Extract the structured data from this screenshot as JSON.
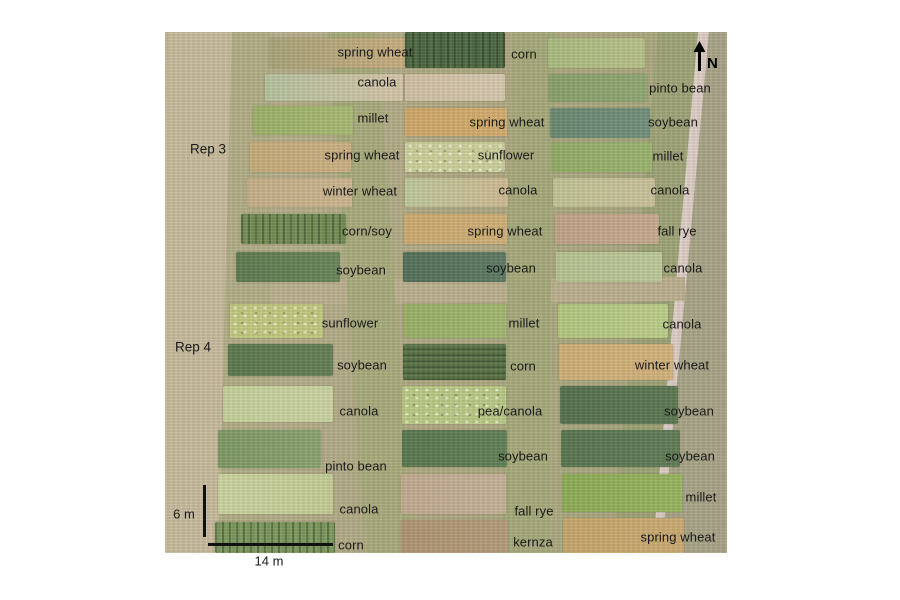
{
  "figure": {
    "type": "annotated-aerial-photo",
    "description": "UAV aerial photograph of agricultural research plots with crop labels",
    "north_label": "N",
    "rep_labels": [
      {
        "text": "Rep 3"
      },
      {
        "text": "Rep 4"
      }
    ],
    "scale_bars": {
      "vertical_label": "6 m",
      "horizontal_label": "14 m"
    },
    "background_elements": [
      {
        "name": "dirt-track-left",
        "x": -4,
        "y": -12,
        "w": 64,
        "h": 548,
        "rotate": 1.5,
        "fill": "#c8bb9e"
      },
      {
        "name": "grass-margin-left",
        "x": 58,
        "y": -12,
        "w": 48,
        "h": 548,
        "rotate": 0.5,
        "fill": "#b2ae88"
      },
      {
        "name": "aisle-left-mid",
        "x": 182,
        "y": -12,
        "w": 48,
        "h": 548,
        "rotate": -4,
        "fill": "#a9ac7d"
      },
      {
        "name": "aisle-mid-right",
        "x": 342,
        "y": -12,
        "w": 44,
        "h": 548,
        "rotate": 1,
        "fill": "#a6aa7b"
      },
      {
        "name": "rep-break-strip",
        "x": 45,
        "y": 247,
        "w": 475,
        "h": 24,
        "rotate": -0.5,
        "fill": "#bcb190"
      },
      {
        "name": "grass-verge-right",
        "x": 470,
        "y": -12,
        "w": 40,
        "h": 548,
        "rotate": 5,
        "fill": "#9fa478"
      },
      {
        "name": "road",
        "x": 484,
        "y": -14,
        "w": 36,
        "h": 552,
        "rotate": 5.2,
        "fill": "#e9dfdc",
        "fill2": "#dcccc4"
      },
      {
        "name": "far-grass-right",
        "x": 516,
        "y": -14,
        "w": 72,
        "h": 552,
        "rotate": 5.2,
        "fill": "#a8a488"
      }
    ],
    "plots": [
      {
        "crop": "spring wheat",
        "col": "left",
        "row": 1,
        "rect": {
          "x": 105,
          "y": 6,
          "w": 137,
          "h": 30
        },
        "fill": "#aaa47a",
        "fill2": "#c9ae80",
        "texture": null,
        "label": {
          "x": 210,
          "y": 20
        }
      },
      {
        "crop": "canola",
        "col": "left",
        "row": 2,
        "rect": {
          "x": 100,
          "y": 42,
          "w": 138,
          "h": 27
        },
        "fill": "#b5c3a0",
        "fill2": "#d6c6aa",
        "texture": null,
        "label": {
          "x": 212,
          "y": 50
        }
      },
      {
        "crop": "millet",
        "col": "left",
        "row": 3,
        "rect": {
          "x": 88,
          "y": 74,
          "w": 100,
          "h": 29
        },
        "fill": "#9cb169",
        "fill2": "#a9ba75",
        "texture": null,
        "label": {
          "x": 208,
          "y": 86
        }
      },
      {
        "crop": "spring wheat",
        "col": "left",
        "row": 4,
        "rect": {
          "x": 85,
          "y": 110,
          "w": 101,
          "h": 30
        },
        "fill": "#c6ac7b",
        "fill2": "#ccb184",
        "texture": null,
        "label": {
          "x": 197,
          "y": 123
        }
      },
      {
        "crop": "winter wheat",
        "col": "left",
        "row": 5,
        "rect": {
          "x": 82,
          "y": 146,
          "w": 105,
          "h": 29
        },
        "fill": "#c6b089",
        "fill2": "#cdb591",
        "texture": null,
        "label": {
          "x": 195,
          "y": 159
        }
      },
      {
        "crop": "corn/soy",
        "col": "left",
        "row": 6,
        "rect": {
          "x": 76,
          "y": 182,
          "w": 105,
          "h": 30
        },
        "fill": "#748d56",
        "fill2": null,
        "texture": "rows-v",
        "label": {
          "x": 202,
          "y": 199
        }
      },
      {
        "crop": "soybean",
        "col": "left",
        "row": 7,
        "rect": {
          "x": 71,
          "y": 220,
          "w": 104,
          "h": 30
        },
        "fill": "#5e7a50",
        "fill2": "#68855a",
        "texture": null,
        "label": {
          "x": 196,
          "y": 238
        }
      },
      {
        "crop": "sunflower",
        "col": "left",
        "row": 8,
        "rect": {
          "x": 65,
          "y": 272,
          "w": 93,
          "h": 34
        },
        "fill": "#c1c980",
        "fill2": null,
        "texture": "speckle",
        "label": {
          "x": 185,
          "y": 291
        }
      },
      {
        "crop": "soybean",
        "col": "left",
        "row": 9,
        "rect": {
          "x": 63,
          "y": 312,
          "w": 105,
          "h": 32
        },
        "fill": "#5c784f",
        "fill2": "#647f56",
        "texture": null,
        "label": {
          "x": 197,
          "y": 333
        }
      },
      {
        "crop": "canola",
        "col": "left",
        "row": 10,
        "rect": {
          "x": 58,
          "y": 354,
          "w": 110,
          "h": 36
        },
        "fill": "#c6d19c",
        "fill2": "#ccd5a3",
        "texture": null,
        "label": {
          "x": 194,
          "y": 379
        }
      },
      {
        "crop": "pinto bean",
        "col": "left",
        "row": 11,
        "rect": {
          "x": 53,
          "y": 398,
          "w": 103,
          "h": 38
        },
        "fill": "#7e9965",
        "fill2": "#8aa471",
        "texture": null,
        "label": {
          "x": 191,
          "y": 434
        }
      },
      {
        "crop": "canola",
        "col": "left",
        "row": 12,
        "rect": {
          "x": 53,
          "y": 442,
          "w": 115,
          "h": 40
        },
        "fill": "#ccd4a1",
        "fill2": "#c4ce97",
        "texture": null,
        "label": {
          "x": 194,
          "y": 477
        }
      },
      {
        "crop": "corn",
        "col": "left",
        "row": 13,
        "rect": {
          "x": 50,
          "y": 490,
          "w": 120,
          "h": 31
        },
        "fill": "#7d995e",
        "fill2": null,
        "texture": "rows-v",
        "label": {
          "x": 186,
          "y": 513
        }
      },
      {
        "crop": "corn",
        "col": "middle",
        "row": 1,
        "rect": {
          "x": 240,
          "y": 0,
          "w": 100,
          "h": 36
        },
        "fill": "#4d6943",
        "fill2": null,
        "texture": "rows-v",
        "label": {
          "x": 359,
          "y": 22
        }
      },
      {
        "crop": null,
        "col": "middle",
        "row": 2,
        "rect": {
          "x": 240,
          "y": 42,
          "w": 100,
          "h": 27
        },
        "fill": "#d2c1a7",
        "fill2": "#d8c9b0",
        "texture": null,
        "label": null
      },
      {
        "crop": "spring wheat",
        "col": "middle",
        "row": 3,
        "rect": {
          "x": 240,
          "y": 76,
          "w": 102,
          "h": 28
        },
        "fill": "#d0a769",
        "fill2": "#d4ad6f",
        "texture": null,
        "label": {
          "x": 342,
          "y": 90
        }
      },
      {
        "crop": "sunflower",
        "col": "middle",
        "row": 4,
        "rect": {
          "x": 240,
          "y": 110,
          "w": 100,
          "h": 30
        },
        "fill": "#ccd19c",
        "fill2": null,
        "texture": "speckle",
        "label": {
          "x": 341,
          "y": 123
        }
      },
      {
        "crop": "canola",
        "col": "middle",
        "row": 5,
        "rect": {
          "x": 240,
          "y": 146,
          "w": 103,
          "h": 29
        },
        "fill": "#bfc99d",
        "fill2": "#cfbc94",
        "texture": null,
        "label": {
          "x": 353,
          "y": 158
        }
      },
      {
        "crop": "spring wheat",
        "col": "middle",
        "row": 6,
        "rect": {
          "x": 239,
          "y": 182,
          "w": 103,
          "h": 30
        },
        "fill": "#cdab71",
        "fill2": "#d1b078",
        "texture": null,
        "label": {
          "x": 340,
          "y": 199
        }
      },
      {
        "crop": "soybean",
        "col": "middle",
        "row": 7,
        "rect": {
          "x": 238,
          "y": 220,
          "w": 103,
          "h": 30
        },
        "fill": "#546f5b",
        "fill2": "#5d7a64",
        "texture": null,
        "label": {
          "x": 346,
          "y": 236
        }
      },
      {
        "crop": "millet",
        "col": "middle",
        "row": 8,
        "rect": {
          "x": 238,
          "y": 272,
          "w": 103,
          "h": 34
        },
        "fill": "#99b066",
        "fill2": "#a3b871",
        "texture": null,
        "label": {
          "x": 359,
          "y": 291
        }
      },
      {
        "crop": "corn",
        "col": "middle",
        "row": 9,
        "rect": {
          "x": 238,
          "y": 312,
          "w": 103,
          "h": 36
        },
        "fill": "#5b7449",
        "fill2": null,
        "texture": "rows-h",
        "label": {
          "x": 358,
          "y": 334
        }
      },
      {
        "crop": "pea/canola",
        "col": "middle",
        "row": 10,
        "rect": {
          "x": 237,
          "y": 354,
          "w": 104,
          "h": 38
        },
        "fill": "#bac986",
        "fill2": null,
        "texture": "speckle",
        "label": {
          "x": 345,
          "y": 379
        }
      },
      {
        "crop": "soybean",
        "col": "middle",
        "row": 11,
        "rect": {
          "x": 237,
          "y": 398,
          "w": 105,
          "h": 37
        },
        "fill": "#597850",
        "fill2": "#617f57",
        "texture": null,
        "label": {
          "x": 358,
          "y": 424
        }
      },
      {
        "crop": "fall rye",
        "col": "middle",
        "row": 12,
        "rect": {
          "x": 236,
          "y": 442,
          "w": 105,
          "h": 40
        },
        "fill": "#c1ac91",
        "fill2": "#c7b29a",
        "texture": null,
        "label": {
          "x": 369,
          "y": 479
        }
      },
      {
        "crop": "kernza",
        "col": "middle",
        "row": 13,
        "rect": {
          "x": 236,
          "y": 488,
          "w": 107,
          "h": 33
        },
        "fill": "#af9573",
        "fill2": "#b59c7c",
        "texture": null,
        "label": {
          "x": 368,
          "y": 510
        }
      },
      {
        "crop": null,
        "col": "right",
        "row": 1,
        "rect": {
          "x": 383,
          "y": 6,
          "w": 97,
          "h": 30
        },
        "fill": "#abbc81",
        "fill2": "#b8c28b",
        "texture": null,
        "label": null
      },
      {
        "crop": "pinto bean",
        "col": "right",
        "row": 2,
        "rect": {
          "x": 384,
          "y": 42,
          "w": 98,
          "h": 28
        },
        "fill": "#89a06b",
        "fill2": "#91a873",
        "texture": null,
        "label": {
          "x": 515,
          "y": 56
        }
      },
      {
        "crop": "soybean",
        "col": "right",
        "row": 3,
        "rect": {
          "x": 385,
          "y": 76,
          "w": 100,
          "h": 30
        },
        "fill": "#6a8973",
        "fill2": "#728f7b",
        "texture": null,
        "label": {
          "x": 508,
          "y": 90
        }
      },
      {
        "crop": "millet",
        "col": "right",
        "row": 4,
        "rect": {
          "x": 387,
          "y": 110,
          "w": 100,
          "h": 30
        },
        "fill": "#93ac67",
        "fill2": "#9cb470",
        "texture": null,
        "label": {
          "x": 503,
          "y": 124
        }
      },
      {
        "crop": "canola",
        "col": "right",
        "row": 5,
        "rect": {
          "x": 388,
          "y": 146,
          "w": 102,
          "h": 29
        },
        "fill": "#c1c596",
        "fill2": "#ccc29b",
        "texture": null,
        "label": {
          "x": 505,
          "y": 158
        }
      },
      {
        "crop": "fall rye",
        "col": "right",
        "row": 6,
        "rect": {
          "x": 390,
          "y": 182,
          "w": 104,
          "h": 30
        },
        "fill": "#c2a389",
        "fill2": "#c8ab90",
        "texture": null,
        "label": {
          "x": 512,
          "y": 199
        }
      },
      {
        "crop": "canola",
        "col": "right",
        "row": 7,
        "rect": {
          "x": 391,
          "y": 220,
          "w": 106,
          "h": 30
        },
        "fill": "#b6c493",
        "fill2": "#bdca9a",
        "texture": null,
        "label": {
          "x": 518,
          "y": 236
        }
      },
      {
        "crop": "canola",
        "col": "right",
        "row": 8,
        "rect": {
          "x": 393,
          "y": 272,
          "w": 110,
          "h": 34
        },
        "fill": "#b3c881",
        "fill2": "#bcce8a",
        "texture": null,
        "label": {
          "x": 517,
          "y": 292
        }
      },
      {
        "crop": "winter wheat",
        "col": "right",
        "row": 9,
        "rect": {
          "x": 394,
          "y": 312,
          "w": 114,
          "h": 36
        },
        "fill": "#cfaf76",
        "fill2": "#d3b37c",
        "texture": null,
        "label": {
          "x": 507,
          "y": 333
        }
      },
      {
        "crop": "soybean",
        "col": "right",
        "row": 10,
        "rect": {
          "x": 395,
          "y": 354,
          "w": 118,
          "h": 38
        },
        "fill": "#55704c",
        "fill2": "#5d7853",
        "texture": null,
        "label": {
          "x": 524,
          "y": 379
        }
      },
      {
        "crop": "soybean",
        "col": "right",
        "row": 11,
        "rect": {
          "x": 396,
          "y": 398,
          "w": 119,
          "h": 37
        },
        "fill": "#597550",
        "fill2": "#617c57",
        "texture": null,
        "label": {
          "x": 525,
          "y": 424
        }
      },
      {
        "crop": "millet",
        "col": "right",
        "row": 12,
        "rect": {
          "x": 397,
          "y": 442,
          "w": 120,
          "h": 38
        },
        "fill": "#8ead56",
        "fill2": "#97b55f",
        "texture": null,
        "label": {
          "x": 536,
          "y": 465
        }
      },
      {
        "crop": "spring wheat",
        "col": "right",
        "row": 13,
        "rect": {
          "x": 398,
          "y": 486,
          "w": 121,
          "h": 35
        },
        "fill": "#c7a66d",
        "fill2": "#ccab73",
        "texture": null,
        "label": {
          "x": 513,
          "y": 505
        }
      }
    ]
  }
}
